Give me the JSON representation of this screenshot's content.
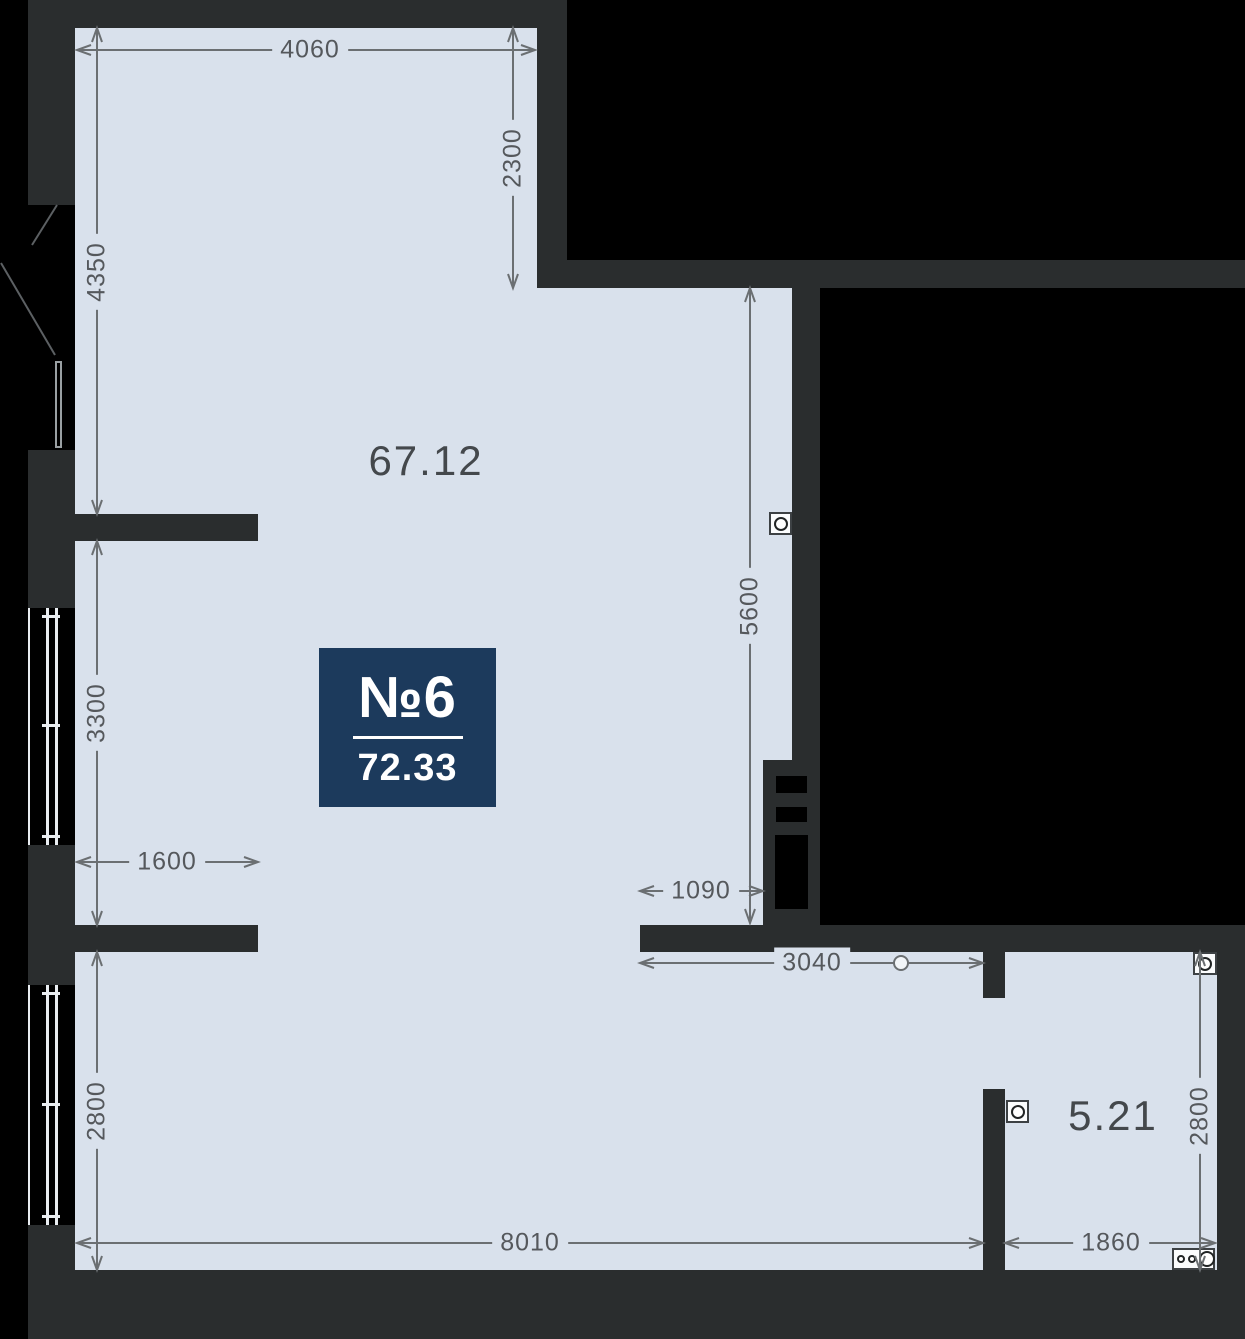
{
  "badge": {
    "number": "№6",
    "area": "72.33"
  },
  "rooms": [
    {
      "name": "main-room",
      "label": "67.12"
    },
    {
      "name": "small-room",
      "label": "5.21"
    }
  ],
  "dimensions": [
    {
      "name": "top-width",
      "value": "4060",
      "orientation": "horizontal"
    },
    {
      "name": "top-right-height",
      "value": "2300",
      "orientation": "vertical"
    },
    {
      "name": "left-upper-height",
      "value": "4350",
      "orientation": "vertical"
    },
    {
      "name": "left-middle-height",
      "value": "3300",
      "orientation": "vertical"
    },
    {
      "name": "left-stub-width",
      "value": "1600",
      "orientation": "horizontal"
    },
    {
      "name": "left-lower-height",
      "value": "2800",
      "orientation": "vertical"
    },
    {
      "name": "bottom-width",
      "value": "8010",
      "orientation": "horizontal"
    },
    {
      "name": "right-inner-height",
      "value": "5600",
      "orientation": "vertical"
    },
    {
      "name": "niche-width",
      "value": "1090",
      "orientation": "horizontal"
    },
    {
      "name": "opening-width",
      "value": "3040",
      "orientation": "horizontal"
    },
    {
      "name": "small-room-width",
      "value": "1860",
      "orientation": "horizontal"
    },
    {
      "name": "small-room-height",
      "value": "2800",
      "orientation": "vertical"
    }
  ],
  "icons": [
    "socket-icon",
    "socket-icon",
    "socket-icon",
    "electrical-panel-icon",
    "door-leaf-icon",
    "vent-shaft"
  ],
  "colors": {
    "background": "#000000",
    "wall": "#2a2d2e",
    "floor": "#d9e1ec",
    "badge_navy": "#1c3a5c",
    "dimension_text": "#55585c",
    "dimension_line": "#6b6f72"
  }
}
